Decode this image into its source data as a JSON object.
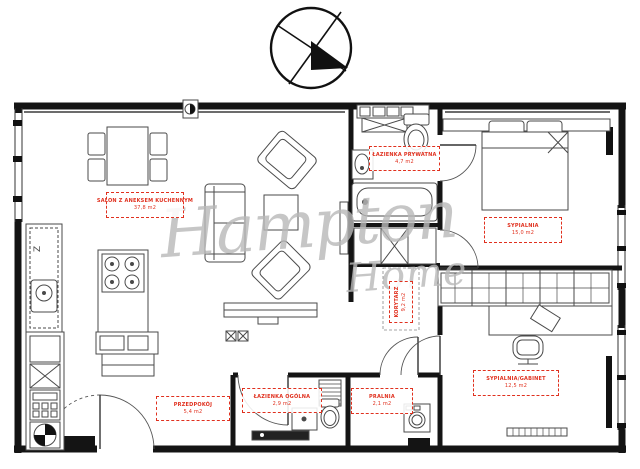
{
  "watermark": {
    "line1": "Hampton",
    "line2": "Home",
    "color": "#b9b9b9"
  },
  "colors": {
    "walls": "#141414",
    "furniture": "#4a4a4a",
    "label_accent": "#e0301e",
    "background": "#ffffff"
  },
  "annotations": {
    "kitchen_mark": "Z"
  },
  "compass": {
    "name": "north-arrow"
  },
  "rooms": [
    {
      "id": "salon",
      "name": "SALON Z ANEKSEM KUCHENNYM",
      "area": "37,8 m2"
    },
    {
      "id": "lazienka-prywatna",
      "name": "ŁAZIENKA PRYWATNA",
      "area": "4,7 m2"
    },
    {
      "id": "sypialnia",
      "name": "SYPIALNIA",
      "area": "15,0 m2"
    },
    {
      "id": "korytarz",
      "name": "KORYTARZ",
      "area": "9,2 m2"
    },
    {
      "id": "przedpokoj",
      "name": "PRZEDPOKÓJ",
      "area": "5,4 m2"
    },
    {
      "id": "lazienka-ogolna",
      "name": "ŁAZIENKA OGÓLNA",
      "area": "2,9 m2"
    },
    {
      "id": "pralnia",
      "name": "PRALNIA",
      "area": "2,1 m2"
    },
    {
      "id": "sypialnia-gabinet",
      "name": "SYPIALNIA/GABINET",
      "area": "12,5 m2"
    }
  ]
}
